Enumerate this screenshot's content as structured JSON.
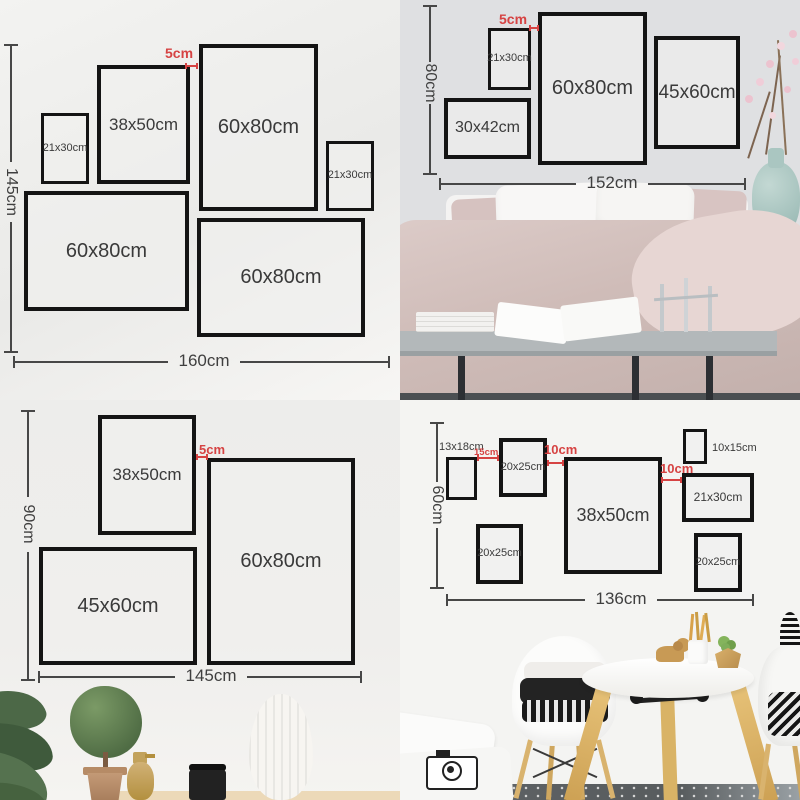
{
  "colors": {
    "accent_red": "#d64343",
    "line": "#474747",
    "frame_border": "#141414"
  },
  "panels": {
    "top_left": {
      "height_label": "145cm",
      "width_label": "160cm",
      "gap_label": "5cm",
      "frames": {
        "f1": "21x30cm",
        "f2": "38x50cm",
        "f3": "60x80cm",
        "f4": "21x30cm",
        "f5": "60x80cm",
        "f6": "60x80cm"
      }
    },
    "top_right": {
      "height_label": "80cm",
      "width_label": "152cm",
      "gap_label": "5cm",
      "frames": {
        "f1": "21x30cm",
        "f2": "60x80cm",
        "f3": "45x60cm",
        "f4": "30x42cm"
      }
    },
    "bottom_left": {
      "height_label": "90cm",
      "width_label": "145cm",
      "gap_label": "5cm",
      "frames": {
        "f1": "38x50cm",
        "f2": "60x80cm",
        "f3": "45x60cm"
      }
    },
    "bottom_right": {
      "height_label": "60cm",
      "width_label": "136cm",
      "gap1_label": "15cm",
      "gap2_label": "10cm",
      "gap3_label": "10cm",
      "frames": {
        "f1": "13x18cm",
        "f2": "20x25cm",
        "f3": "38x50cm",
        "f4": "10x15cm",
        "f5": "21x30cm",
        "f6": "20x25cm",
        "f7": "20x25cm"
      }
    }
  }
}
